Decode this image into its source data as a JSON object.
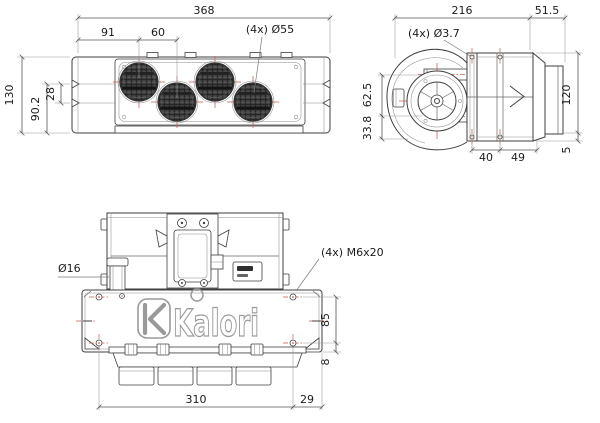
{
  "page": {
    "type": "technical-drawing",
    "product": "Kalori cab heater unit, 3-view dimensioned drawing"
  },
  "brand": {
    "logo_text": "Kalori"
  },
  "colors": {
    "line": "#3f3f3f",
    "dim_line": "#555555",
    "accent_red": "#c75a4f",
    "grille_dark": "#4a4a4a",
    "logo_gray": "#9a9a9a"
  },
  "top_view": {
    "dim_overall_width": "368",
    "dim_vent1_offset": "91",
    "dim_vent_pitch": "60",
    "dim_vent_diameter": "(4x) Ø55",
    "dim_overall_depth": "130",
    "dim_depth_90_2": "90.2",
    "dim_notch_28": "28"
  },
  "side_view": {
    "dim_body_length": "216",
    "dim_outlet_length": "51.5",
    "dim_hole_diameter": "(4x) Ø3.7",
    "dim_height_62_5": "62.5",
    "dim_height_33_8": "33.8",
    "dim_overall_height": "120",
    "dim_foot_5": "5",
    "dim_pitch_40": "40",
    "dim_pitch_49": "49"
  },
  "front_view": {
    "dim_pipe_diameter": "Ø16",
    "dim_screw_spec": "(4x) M6x20",
    "dim_height_85": "85",
    "dim_height_8": "8",
    "dim_mount_width": "310",
    "dim_edge_offset": "29"
  }
}
